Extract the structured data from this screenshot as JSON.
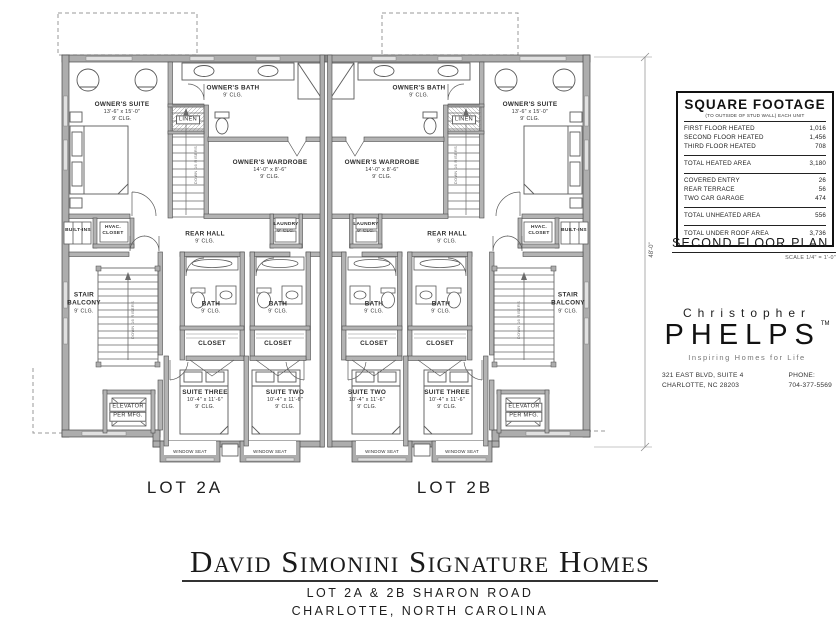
{
  "square_footage": {
    "title": "SQUARE FOOTAGE",
    "subtitle": "(TO OUTSIDE OF STUD WALL) EACH UNIT",
    "rows": [
      {
        "label": "FIRST FLOOR HEATED",
        "value": "1,016"
      },
      {
        "label": "SECOND FLOOR HEATED",
        "value": "1,456"
      },
      {
        "label": "THIRD FLOOR HEATED",
        "value": "708"
      }
    ],
    "total_heated": {
      "label": "TOTAL HEATED AREA",
      "value": "3,180"
    },
    "unheated_rows": [
      {
        "label": "COVERED ENTRY",
        "value": "26"
      },
      {
        "label": "REAR TERRACE",
        "value": "56"
      },
      {
        "label": "TWO CAR GARAGE",
        "value": "474"
      }
    ],
    "total_unheated": {
      "label": "TOTAL UNHEATED AREA",
      "value": "556"
    },
    "total_under_roof": {
      "label": "TOTAL UNDER ROOF AREA",
      "value": "3,736"
    }
  },
  "plan_title": {
    "text": "SECOND FLOOR PLAN",
    "scale": "SCALE 1/4\" = 1'-0\""
  },
  "architect": {
    "first_name": "Christopher",
    "last_name": "PHELPS",
    "tm": "TM",
    "tagline": "Inspiring Homes for Life",
    "address1": "321 EAST BLVD, SUITE 4",
    "address2": "CHARLOTTE, NC 28203",
    "phone_label": "PHONE:",
    "phone": "704-377-5569"
  },
  "title_block": {
    "company": "David Simonini Signature Homes",
    "line2": "LOT 2A & 2B SHARON ROAD",
    "line3": "CHARLOTTE, NORTH CAROLINA"
  },
  "lots": {
    "left": "LOT 2A",
    "right": "LOT 2B"
  },
  "dimension": {
    "right_overall": "48'-0\""
  },
  "plan": {
    "stair_note": "DOWN 16 RISERS",
    "labels": {
      "owners_suite": {
        "l1": "OWNER'S SUITE",
        "l2": "13'-6\" x 15'-0\"",
        "l3": "9' CLG."
      },
      "owners_bath": {
        "l1": "OWNER'S BATH",
        "l2": "9' CLG."
      },
      "linen": {
        "l1": "LINEN"
      },
      "owners_wardrobe": {
        "l1": "OWNER'S WARDROBE",
        "l2": "14'-0\" x 8'-6\"",
        "l3": "9' CLG."
      },
      "built_ins": {
        "l1": "BUILT-INS"
      },
      "hvac": {
        "l1": "HVAC.",
        "l2": "CLOSET"
      },
      "rear_hall": {
        "l1": "REAR HALL",
        "l2": "9' CLG."
      },
      "laundry": {
        "l1": "LAUNDRY",
        "l2": "9' CLG."
      },
      "stair_balcony": {
        "l1": "STAIR",
        "l2": "BALCONY",
        "l3": "9' CLG."
      },
      "bath": {
        "l1": "BATH",
        "l2": "9' CLG."
      },
      "closet": {
        "l1": "CLOSET"
      },
      "suite_three": {
        "l1": "SUITE THREE",
        "l2": "10'-4\" x 11'-6\"",
        "l3": "9' CLG."
      },
      "suite_two": {
        "l1": "SUITE TWO",
        "l2": "10'-4\" x 11'-6\"",
        "l3": "9' CLG."
      },
      "elevator": {
        "l1": "ELEVATOR",
        "l2": "PER MFG."
      },
      "window_seat": {
        "l1": "WINDOW SEAT"
      }
    }
  },
  "colors": {
    "wall_fill": "#adadad",
    "wall_edge": "#4a4a4a",
    "line": "#666666",
    "dashed": "#9a9a9a",
    "ink": "#1a1a1a"
  }
}
